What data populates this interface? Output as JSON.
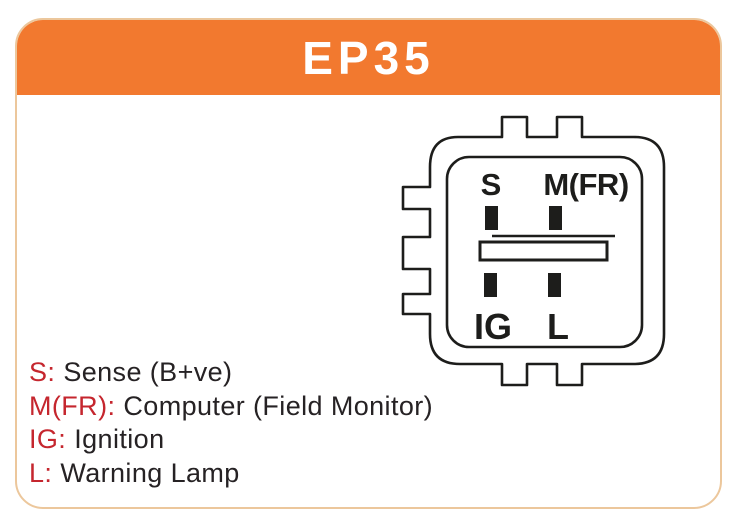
{
  "header": {
    "title": "EP35",
    "bg_color": "#f2792f",
    "text_color": "#ffffff"
  },
  "card": {
    "border_color": "#ecc79c",
    "bg_color": "#ffffff"
  },
  "connector": {
    "outline_color": "#1d1d1b",
    "pins": [
      {
        "id": "S",
        "label": "S",
        "position": "top-left"
      },
      {
        "id": "M(FR)",
        "label": "M(FR)",
        "position": "top-right"
      },
      {
        "id": "IG",
        "label": "IG",
        "position": "bottom-left"
      },
      {
        "id": "L",
        "label": "L",
        "position": "bottom-right"
      }
    ]
  },
  "legend": {
    "key_color": "#c5262e",
    "text_color": "#262224",
    "items": [
      {
        "key": "S:",
        "description": "Sense (B+ve)"
      },
      {
        "key": "M(FR):",
        "description": "Computer (Field Monitor)"
      },
      {
        "key": "IG:",
        "description": "Ignition"
      },
      {
        "key": "L:",
        "description": "Warning Lamp"
      }
    ]
  }
}
